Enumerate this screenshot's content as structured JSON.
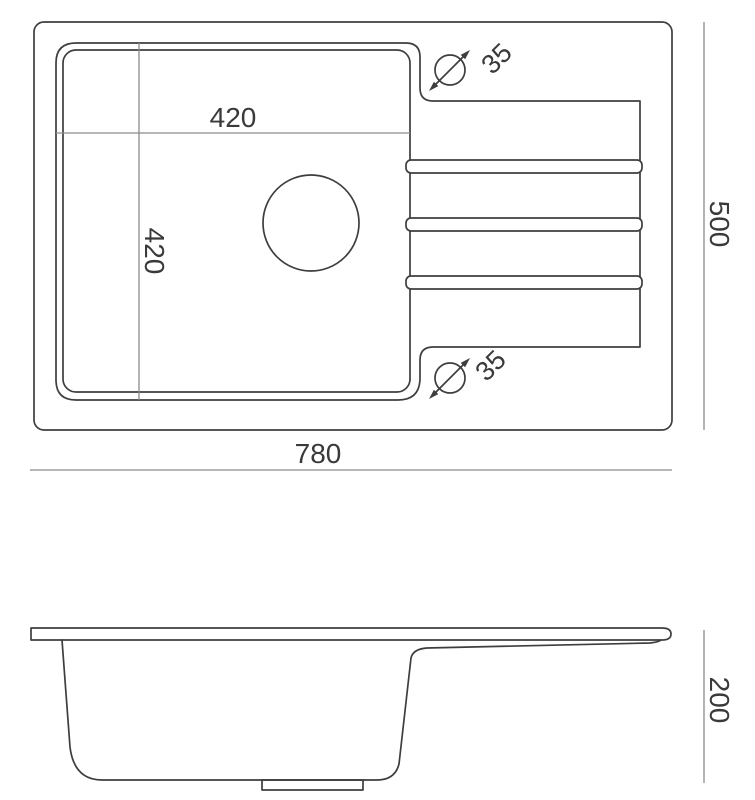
{
  "drawing_title": "sink-dimension-drawing",
  "top_view": {
    "labels": {
      "bowl_width": "420",
      "bowl_depth": "420",
      "overall_width": "780",
      "overall_depth": "500",
      "tap_hole_top": "35",
      "tap_hole_bottom": "35"
    }
  },
  "side_view": {
    "labels": {
      "height": "200"
    }
  },
  "colors": {
    "line": "#3e3e3e",
    "dim_line": "#8c8c8c",
    "text": "#3a3a3a",
    "background": "#ffffff"
  }
}
